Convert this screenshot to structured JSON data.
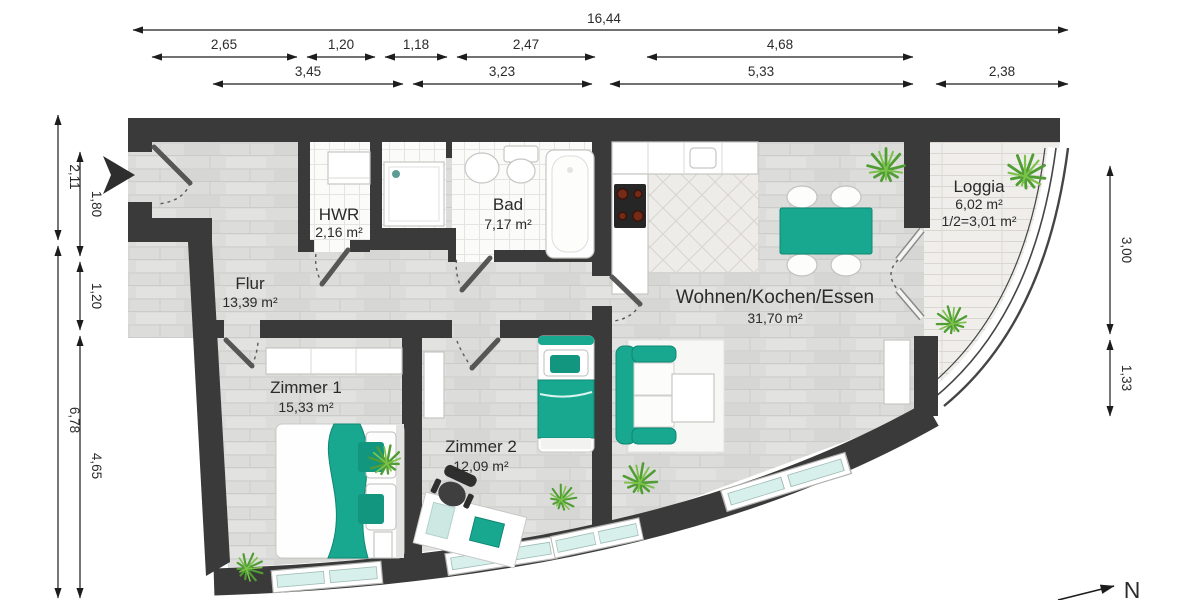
{
  "meta": {
    "type": "floor-plan",
    "language": "de"
  },
  "colors": {
    "accent": "#18a890",
    "wall": "#3a3a3a",
    "glass": "#d8f0ec",
    "plant": "#4f9d33"
  },
  "dims": {
    "top_total": "16,44",
    "top_row2": [
      "2,65",
      "1,20",
      "1,18",
      "2,47",
      "4,68"
    ],
    "top_row3": [
      "3,45",
      "3,23",
      "5,33",
      "2,38"
    ],
    "left_outer": [
      "2,11",
      "6,78"
    ],
    "left_inner": [
      "1,80",
      "1,20",
      "4,65"
    ],
    "right_side": [
      "3,00",
      "1,33"
    ]
  },
  "rooms": {
    "hwr": {
      "name": "HWR",
      "area": "2,16 m²"
    },
    "bad": {
      "name": "Bad",
      "area": "7,17 m²"
    },
    "flur": {
      "name": "Flur",
      "area": "13,39 m²"
    },
    "zimmer1": {
      "name": "Zimmer 1",
      "area": "15,33 m²"
    },
    "zimmer2": {
      "name": "Zimmer 2",
      "area": "12,09 m²"
    },
    "wohnen": {
      "name": "Wohnen/Kochen/Essen",
      "area": "31,70 m²"
    },
    "loggia": {
      "name": "Loggia",
      "area": "6,02 m²",
      "area_half": "1/2=3,01 m²"
    }
  },
  "compass": {
    "north": "N"
  }
}
